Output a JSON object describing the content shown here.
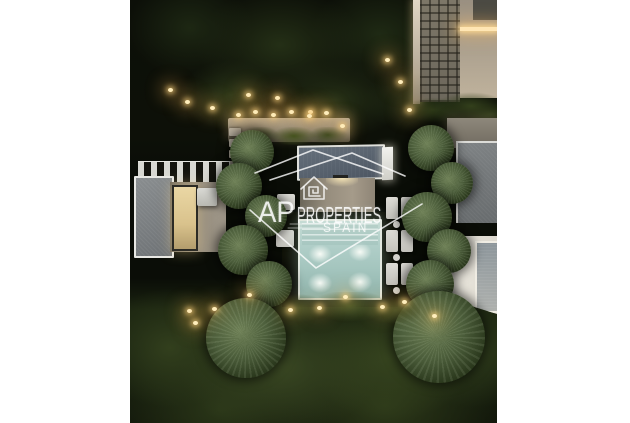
{
  "watermark": {
    "initials": "AP",
    "name": "PROPERTIES",
    "country": "SPAIN",
    "color": "#ffffff",
    "logo_icon": "house-spiral-icon",
    "logo_motif": "roofline-outline"
  },
  "scene": {
    "description": "Aerial night render of a modern villa with illuminated swimming pool, sun loungers, pine trees and garden lighting, pillarboxed on a white background",
    "frame_background": "#ffffff",
    "colors": {
      "vegetation_dark": "#1d2713",
      "vegetation_olive": "#3a4823",
      "pool_water": "#b1cfc9",
      "pool_glow": "#fafdf8",
      "villa_roof": "#58626e",
      "warm_light": "#ffe6b4",
      "lounger_white": "#dddcd6"
    }
  }
}
